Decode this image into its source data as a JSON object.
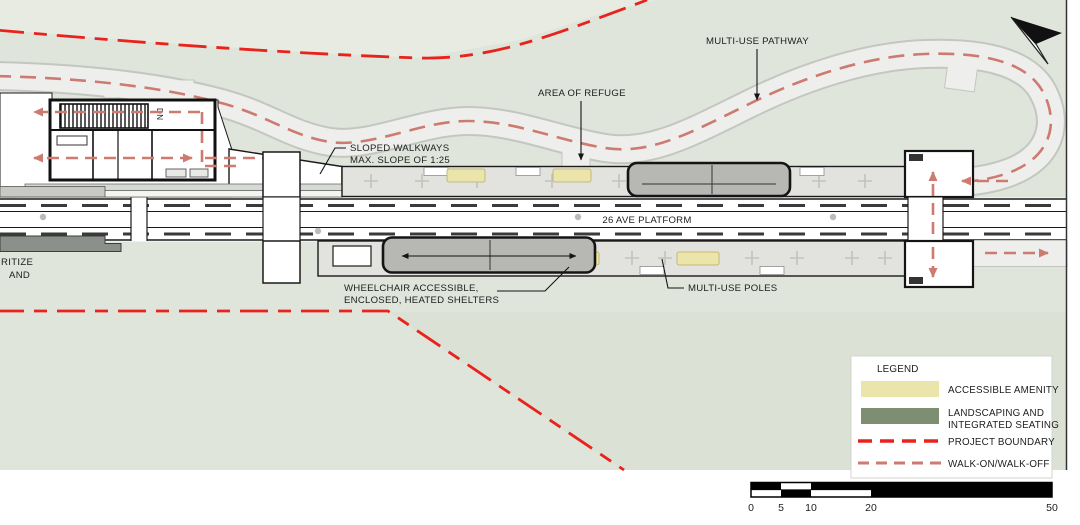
{
  "drawing": {
    "type": "transit-station-site-plan",
    "platform_label": "26 AVE PLATFORM"
  },
  "annotations": {
    "multi_use_pathway": "MULTI-USE PATHWAY",
    "area_of_refuge": "AREA OF REFUGE",
    "sloped_walkways_line1": "SLOPED WALKWAYS",
    "sloped_walkways_line2": "MAX. SLOPE OF 1:25",
    "wheelchair_line1": "WHEELCHAIR ACCESSIBLE,",
    "wheelchair_line2": "ENCLOSED, HEATED SHELTERS",
    "multi_use_poles": "MULTI-USE POLES",
    "stair_down": "DN",
    "cutoff_text_line1": "RITIZE",
    "cutoff_text_line2": "AND"
  },
  "legend": {
    "title": "LEGEND",
    "items": [
      {
        "label": "ACCESSIBLE AMENITY"
      },
      {
        "label_line1": "LANDSCAPING AND",
        "label_line2": "INTEGRATED SEATING"
      },
      {
        "label": "PROJECT BOUNDARY"
      },
      {
        "label": "WALK-ON/WALK-OFF"
      }
    ]
  },
  "scale_bar": {
    "ticks": [
      "0",
      "5",
      "10",
      "20",
      "50"
    ]
  },
  "colors": {
    "accessible_amenity": "#ece5ab",
    "landscaping_seating": "#7d8e72",
    "project_boundary": "#e8231d",
    "walk_on_walk_off": "#cd7a70",
    "background_green": "#dfe5da",
    "pathway_gray": "#eeefec",
    "platform_gray": "#e2e3df",
    "shelter_gray": "#b7b8b4"
  }
}
